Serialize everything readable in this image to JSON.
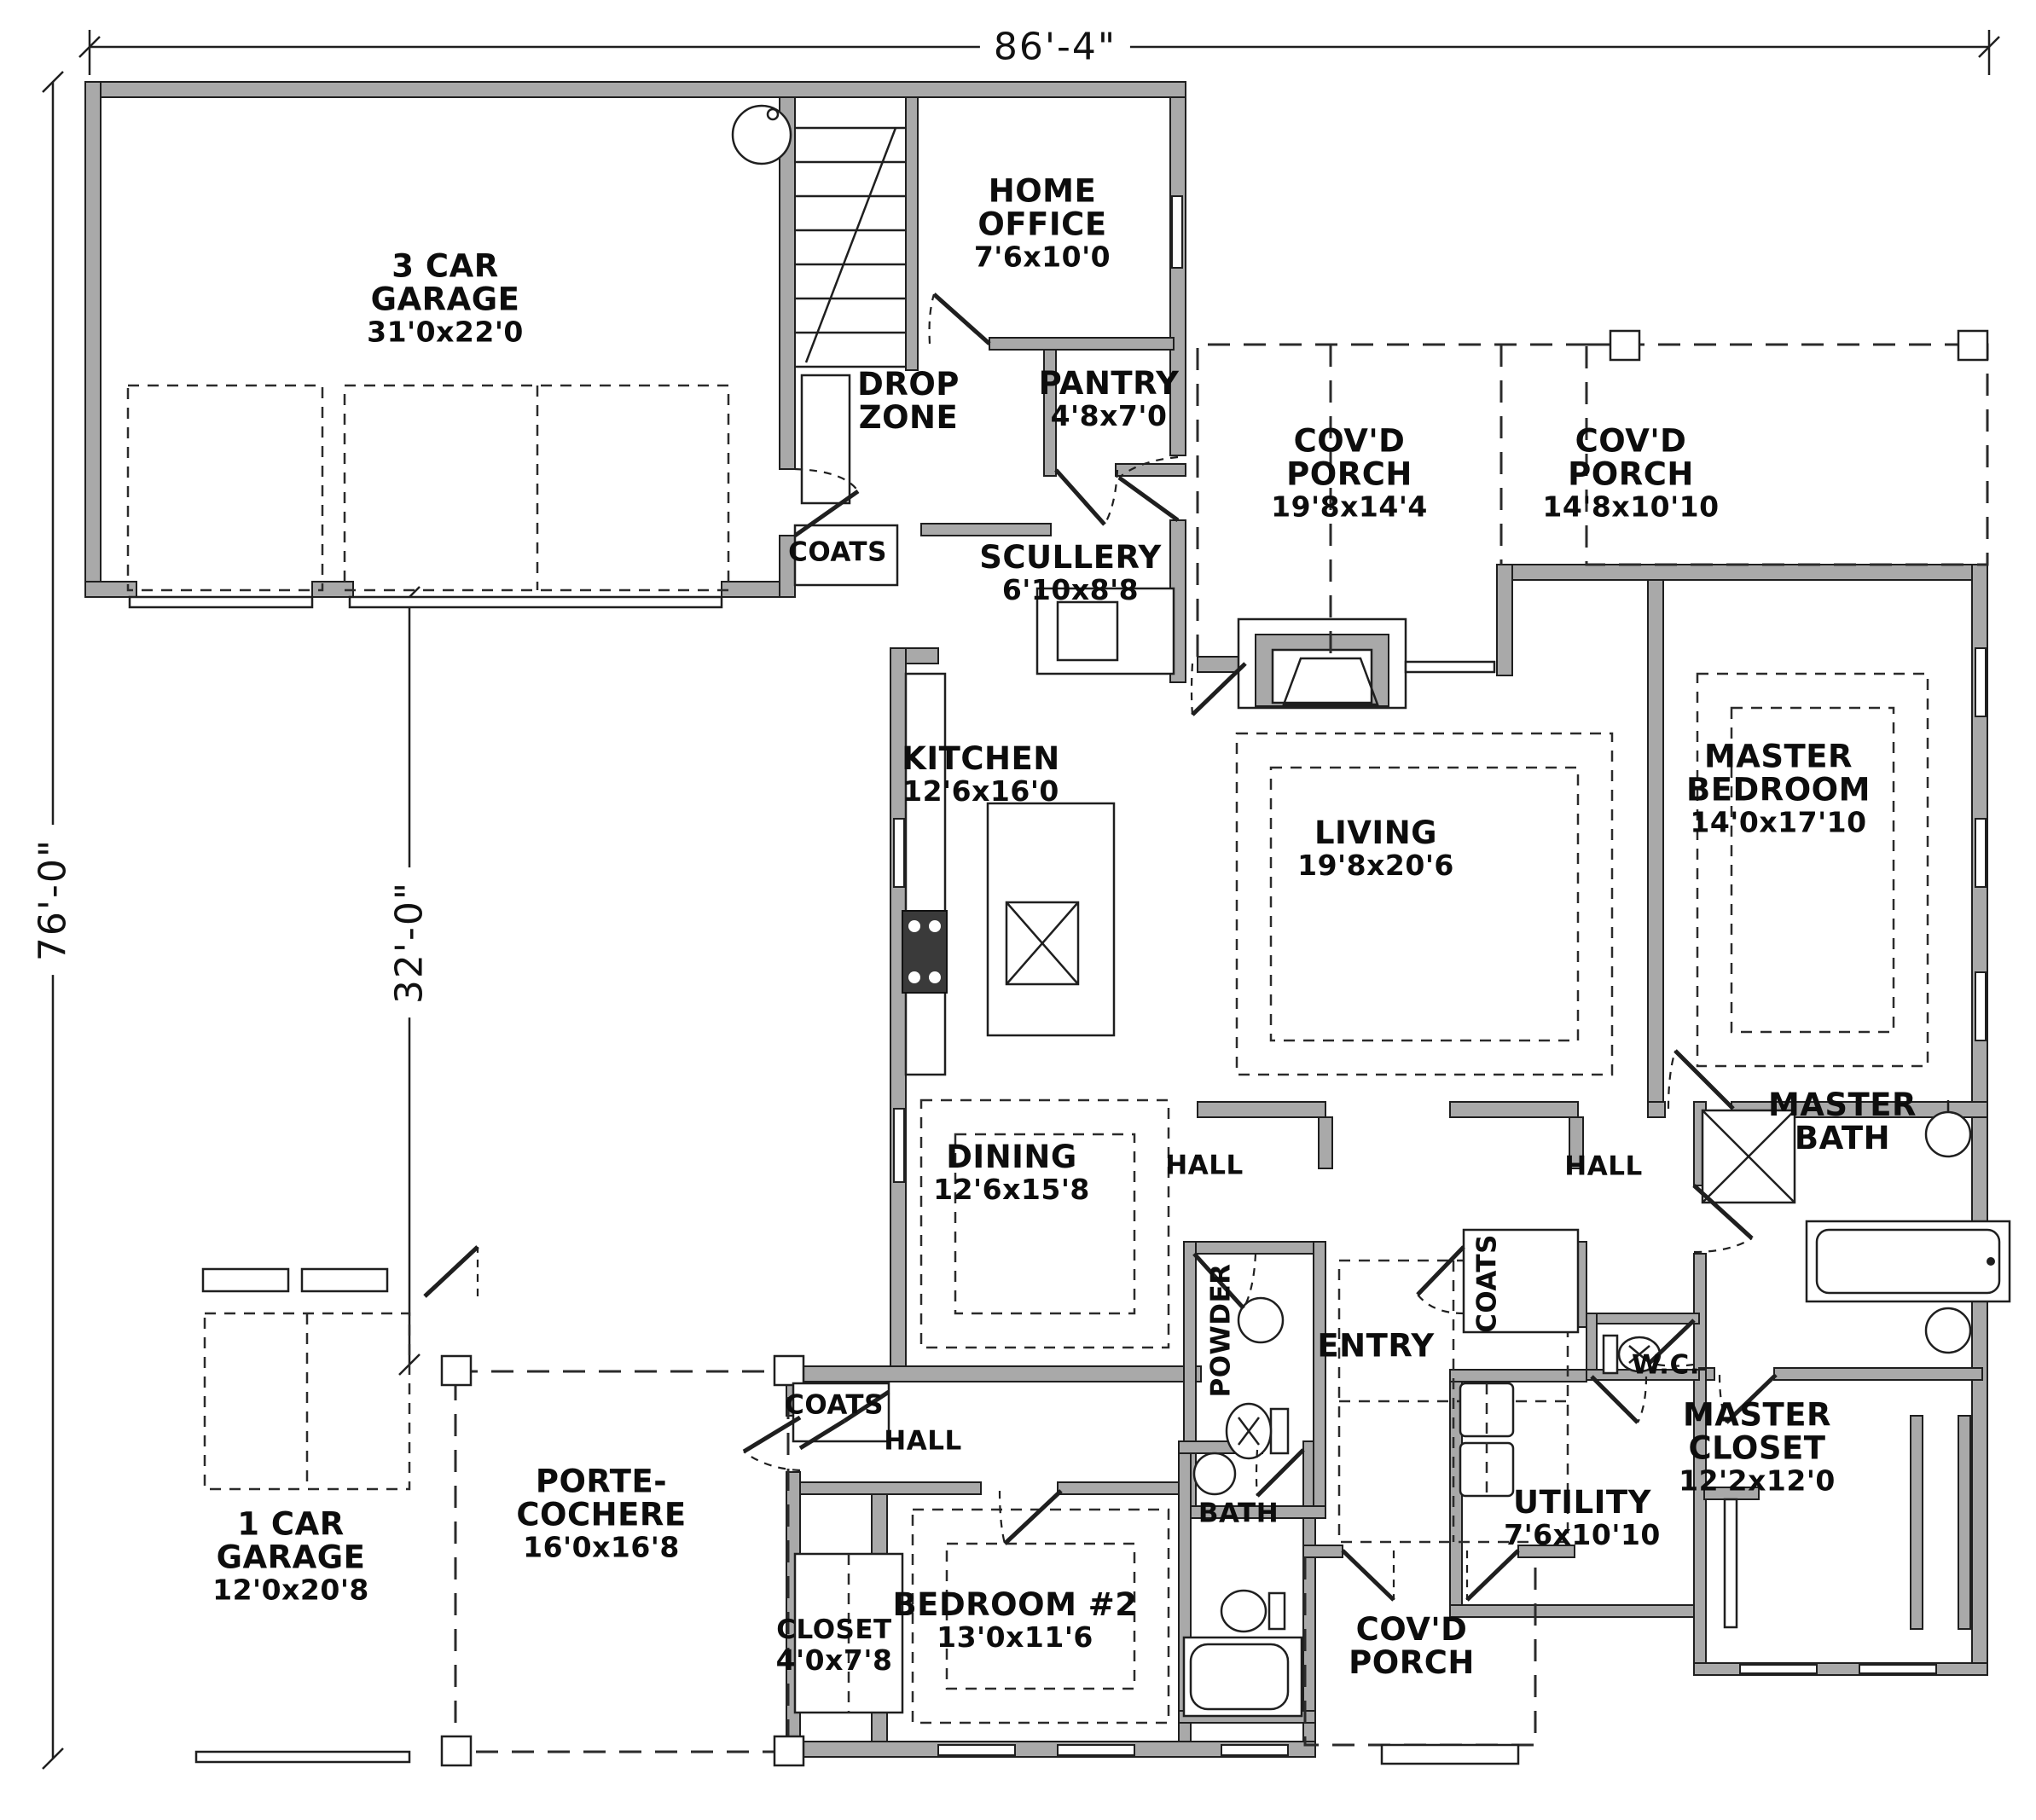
{
  "drawing": {
    "kind": "residential first-floor plan"
  },
  "dimensions": {
    "overall_width": "86'-4\"",
    "overall_depth": "76'-0\"",
    "left_wing_depth": "32'-0\""
  },
  "rooms": {
    "garage3": {
      "label": "3 CAR\nGARAGE",
      "size": "31'0x22'0"
    },
    "home_office": {
      "label": "HOME\nOFFICE",
      "size": "7'6x10'0"
    },
    "drop_zone": {
      "label": "DROP\nZONE",
      "size": ""
    },
    "pantry": {
      "label": "PANTRY",
      "size": "4'8x7'0"
    },
    "coats_mud": {
      "label": "COATS",
      "size": ""
    },
    "scullery": {
      "label": "SCULLERY",
      "size": "6'10x8'8"
    },
    "covd_porch_rear": {
      "label": "COV'D\nPORCH",
      "size": "19'8x14'4"
    },
    "covd_porch_side": {
      "label": "COV'D\nPORCH",
      "size": "14'8x10'10"
    },
    "kitchen": {
      "label": "KITCHEN",
      "size": "12'6x16'0"
    },
    "living": {
      "label": "LIVING",
      "size": "19'8x20'6"
    },
    "master_bedroom": {
      "label": "MASTER\nBEDROOM",
      "size": "14'0x17'10"
    },
    "dining": {
      "label": "DINING",
      "size": "12'6x15'8"
    },
    "hall_center": {
      "label": "HALL",
      "size": ""
    },
    "hall_right": {
      "label": "HALL",
      "size": ""
    },
    "master_bath": {
      "label": "MASTER\nBATH",
      "size": ""
    },
    "powder": {
      "label": "POWDER",
      "size": ""
    },
    "entry": {
      "label": "ENTRY",
      "size": ""
    },
    "coats_entry": {
      "label": "COATS",
      "size": ""
    },
    "wc": {
      "label": "W.C.",
      "size": ""
    },
    "master_closet": {
      "label": "MASTER\nCLOSET",
      "size": "12'2x12'0"
    },
    "utility": {
      "label": "UTILITY",
      "size": "7'6x10'10"
    },
    "covd_porch_front": {
      "label": "COV'D\nPORCH",
      "size": ""
    },
    "bath2": {
      "label": "BATH",
      "size": ""
    },
    "bedroom2": {
      "label": "BEDROOM #2",
      "size": "13'0x11'6"
    },
    "closet2": {
      "label": "CLOSET",
      "size": "4'0x7'8"
    },
    "hall_bottom": {
      "label": "HALL",
      "size": ""
    },
    "coats_hall": {
      "label": "COATS",
      "size": ""
    },
    "porte_cochere": {
      "label": "PORTE-\nCOCHERE",
      "size": "16'0x16'8"
    },
    "garage1": {
      "label": "1 CAR\nGARAGE",
      "size": "12'0x20'8"
    }
  }
}
